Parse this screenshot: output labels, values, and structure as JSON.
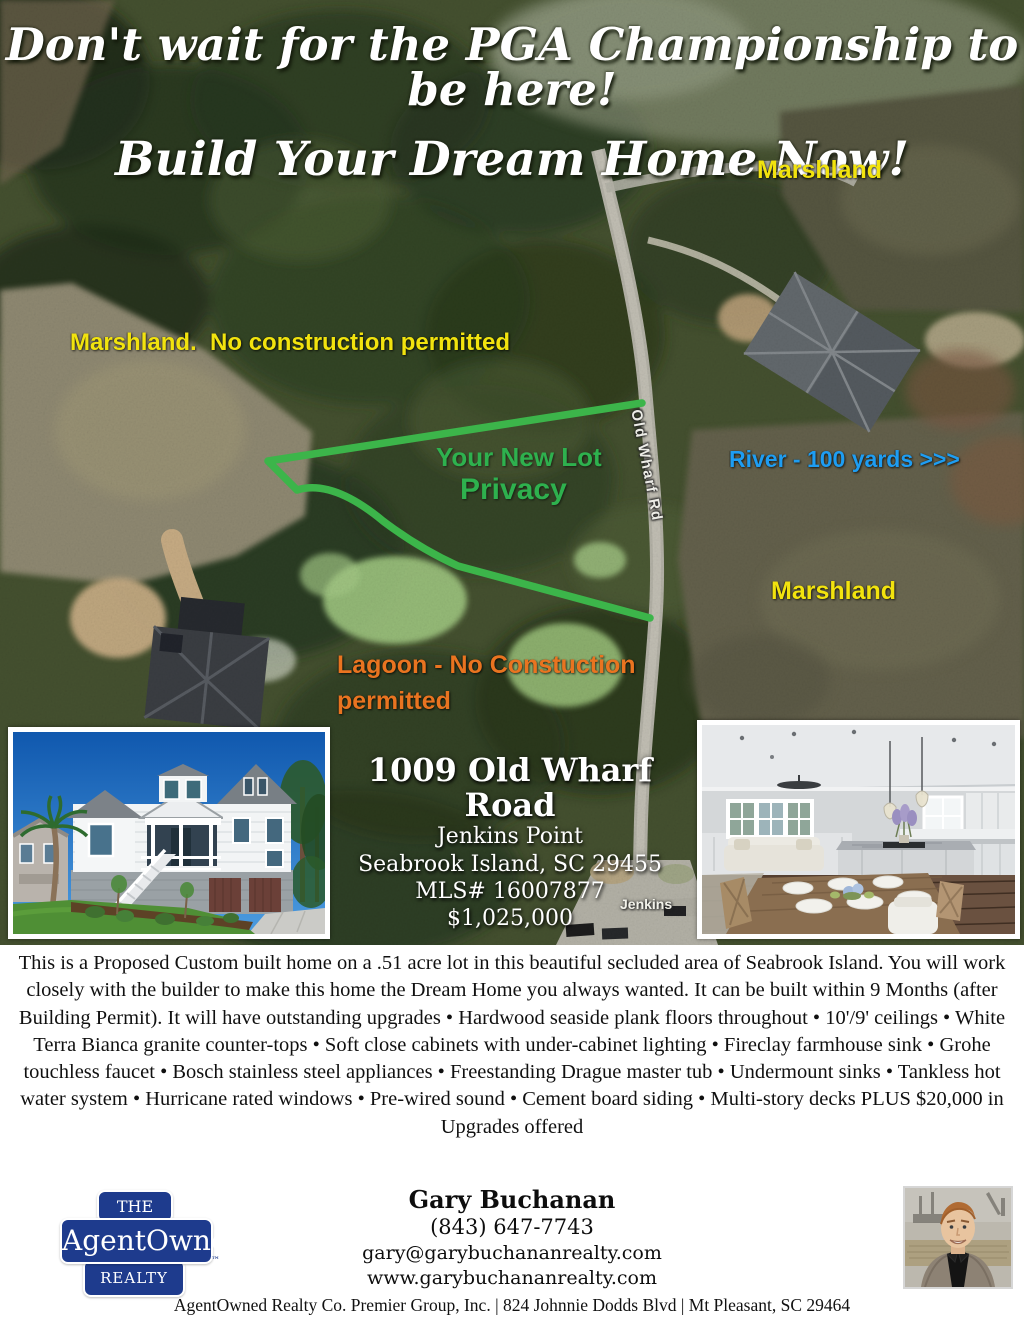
{
  "headline": {
    "line1": "Don't wait for the PGA Championship to be here!",
    "line2": "Build Your Dream Home Now!"
  },
  "map": {
    "labels": {
      "marshland_top": "Marshland",
      "marshland_left": "Marshland.  No construction permitted",
      "lot_title": "Your New Lot",
      "lot_subtitle": "Privacy",
      "river": "River - 100 yards >>>",
      "marshland_right": "Marshland",
      "lagoon_line1": "Lagoon - No Constuction",
      "lagoon_line2": "permitted",
      "road_name": "Old Wharf Rd",
      "street_label": "Jenkins"
    },
    "colors": {
      "marshland_yellow": "#F2E30E",
      "lot_green": "#3CB54A",
      "river_blue": "#1E9DF2",
      "lagoon_orange": "#E97420"
    }
  },
  "property": {
    "address": "1009 Old Wharf Road",
    "neighborhood": "Jenkins Point",
    "city_state_zip": "Seabrook Island, SC 29455",
    "mls": "MLS# 16007877",
    "price": "$1,025,000"
  },
  "description": "This is a Proposed Custom built home on a .51 acre lot in this beautiful secluded area of Seabrook Island. You will work closely with the builder to make this home the Dream Home you always wanted. It can be built within 9 Months (after Building Permit). It will have outstanding upgrades • Hardwood seaside plank floors throughout • 10'/9' ceilings • White Terra Bianca granite counter-tops • Soft close cabinets with under-cabinet lighting • Fireclay farmhouse sink • Grohe touchless faucet • Bosch stainless steel appliances • Freestanding Drague master tub • Undermount sinks • Tankless hot water system • Hurricane rated windows • Pre-wired sound • Cement board siding • Multi-story decks PLUS $20,000 in Upgrades offered",
  "agent": {
    "name": "Gary Buchanan",
    "phone": "(843) 647-7743",
    "email": "gary@garybuchananrealty.com",
    "website": "www.garybuchananrealty.com"
  },
  "brand": {
    "logo_top": "THE",
    "logo_middle": "AgentOwned",
    "logo_bottom": "REALTY CO.",
    "trademark": "™",
    "logo_blue": "#1E3B8D"
  },
  "footer": "AgentOwned Realty Co. Premier Group, Inc. | 824 Johnnie Dodds Blvd | Mt Pleasant, SC 29464"
}
